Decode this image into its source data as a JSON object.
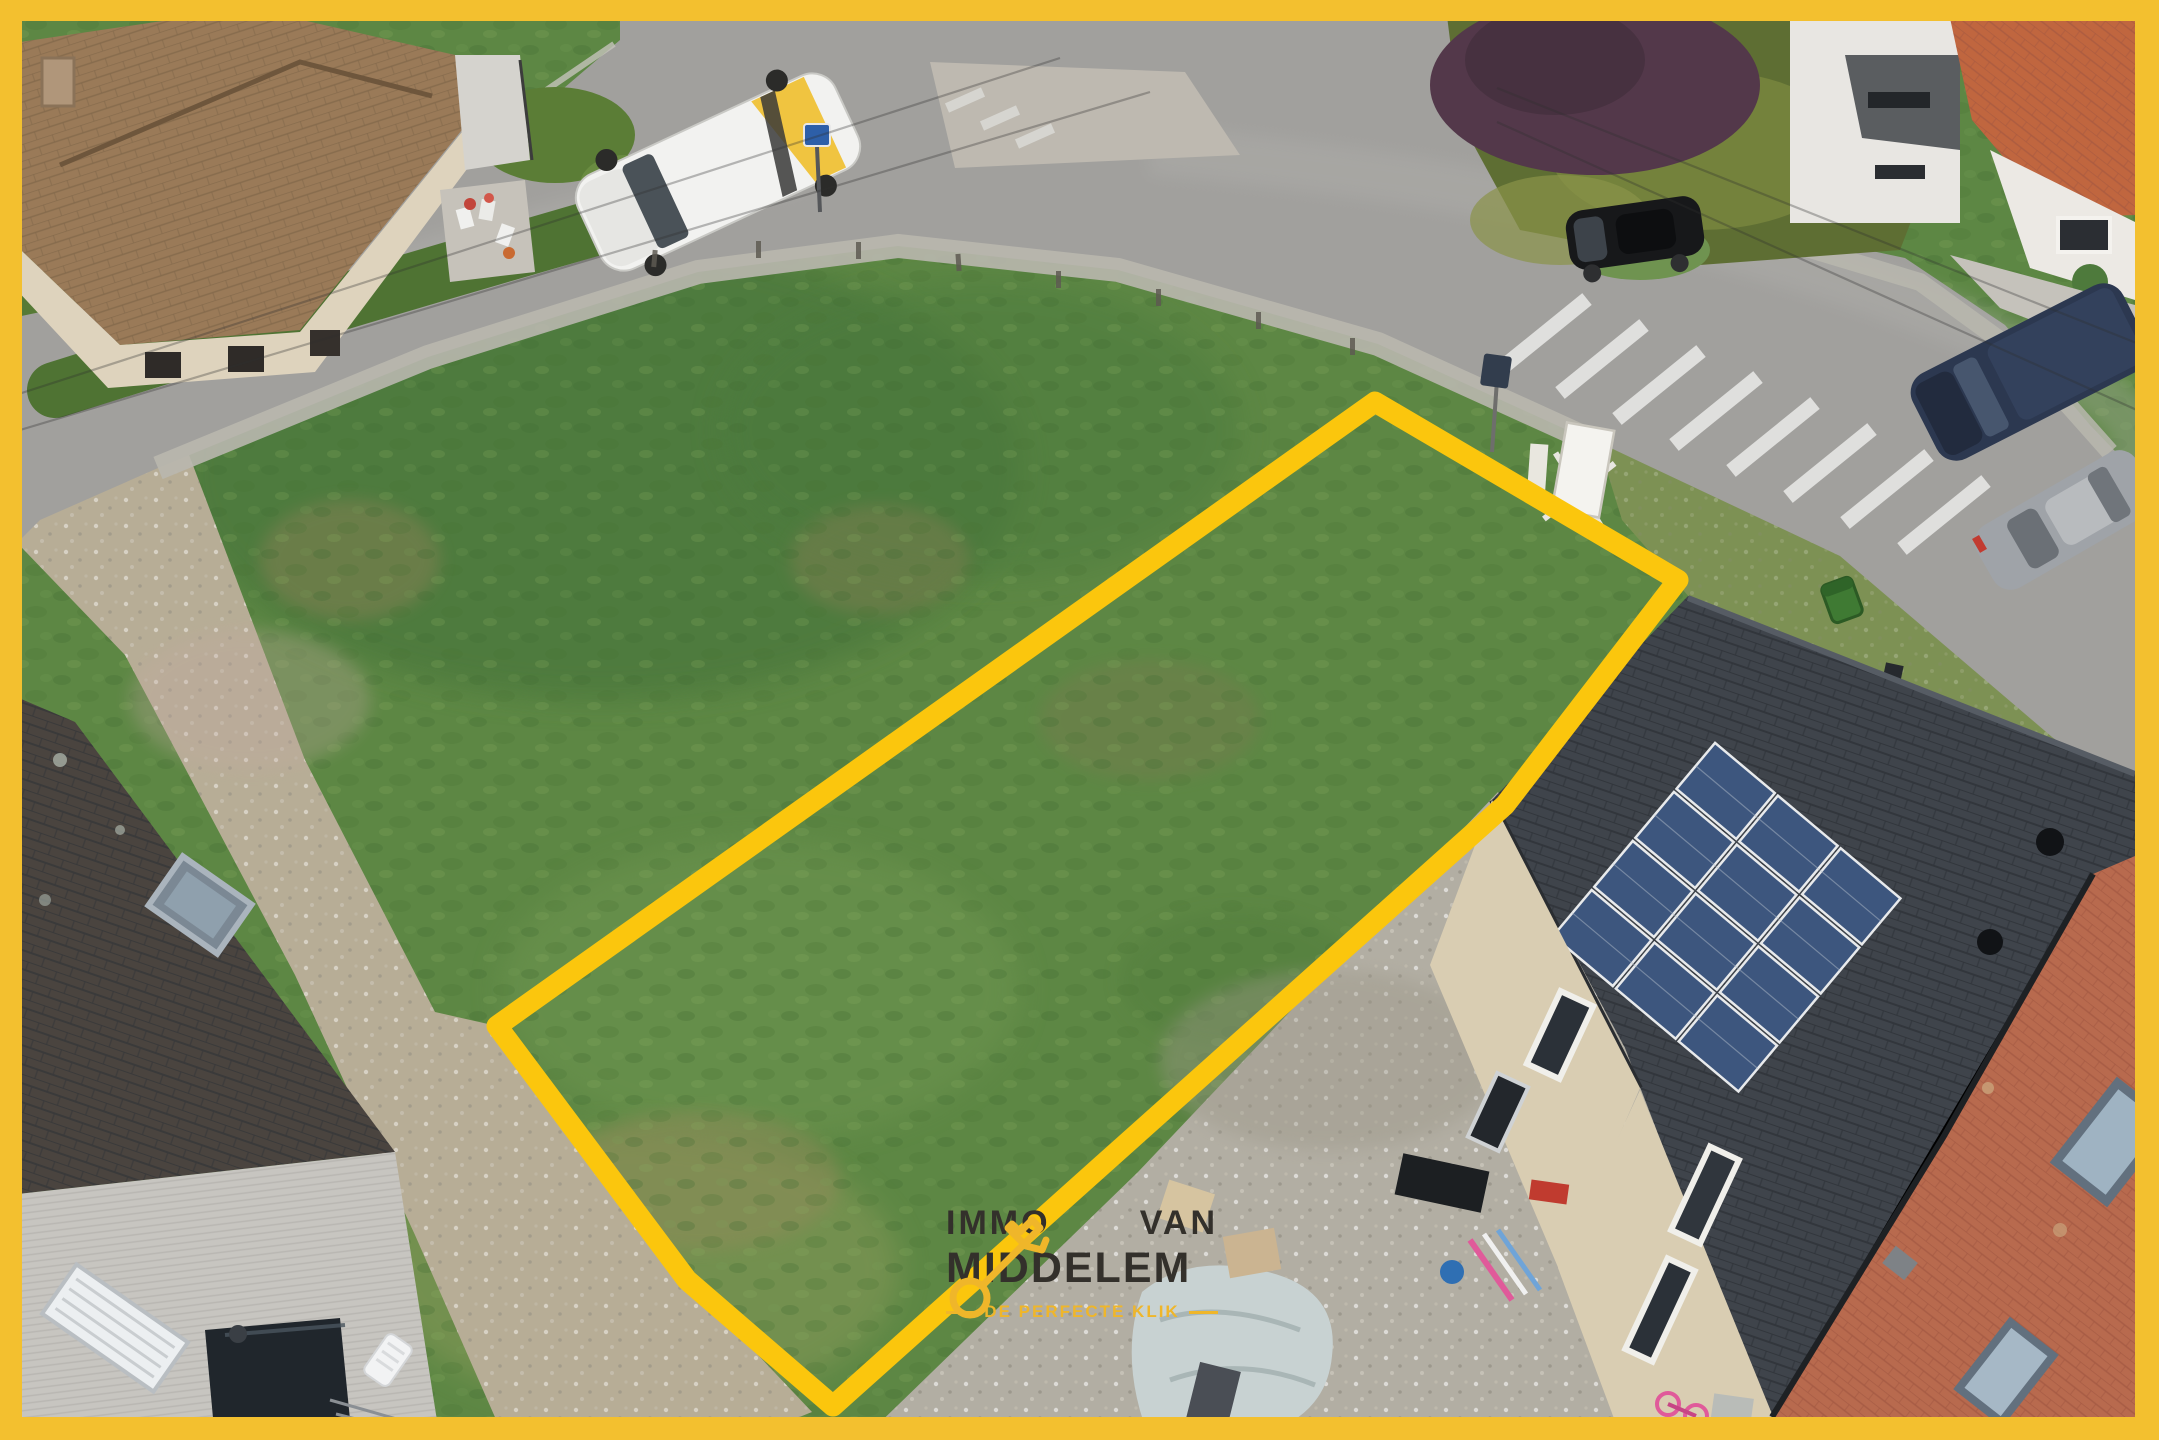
{
  "window": {
    "width": 2159,
    "height": 1440
  },
  "photo": {
    "type": "aerial-drone-photo",
    "subject": "building plot at a street corner outlined in yellow, surrounded by houses, roads and parked vehicles"
  },
  "brand": {
    "frame_color": "#F3C02F",
    "outline_color": "#FBC60D",
    "logo_text_color": "#33302B",
    "accent_color": "#EFB62A"
  },
  "palette": {
    "meadow_green": "#5D8744",
    "road_gray": "#A1A09D",
    "gravel": "#B2AEA3",
    "dirt_path": "#B7AD96",
    "brown_tile_roof": "#9A7A58",
    "dark_tile_roof": "#3F444B",
    "salmon_tile_roof": "#B86A4E",
    "solar_panel_blue": "#3D567E",
    "beige_brick": "#D9CDB2"
  },
  "watermark": {
    "word1": "IMMO",
    "word2": "VAN",
    "word3": "MIDDELEM",
    "tagline": "DE PERFECTE KLIK",
    "icon": "key-icon"
  }
}
